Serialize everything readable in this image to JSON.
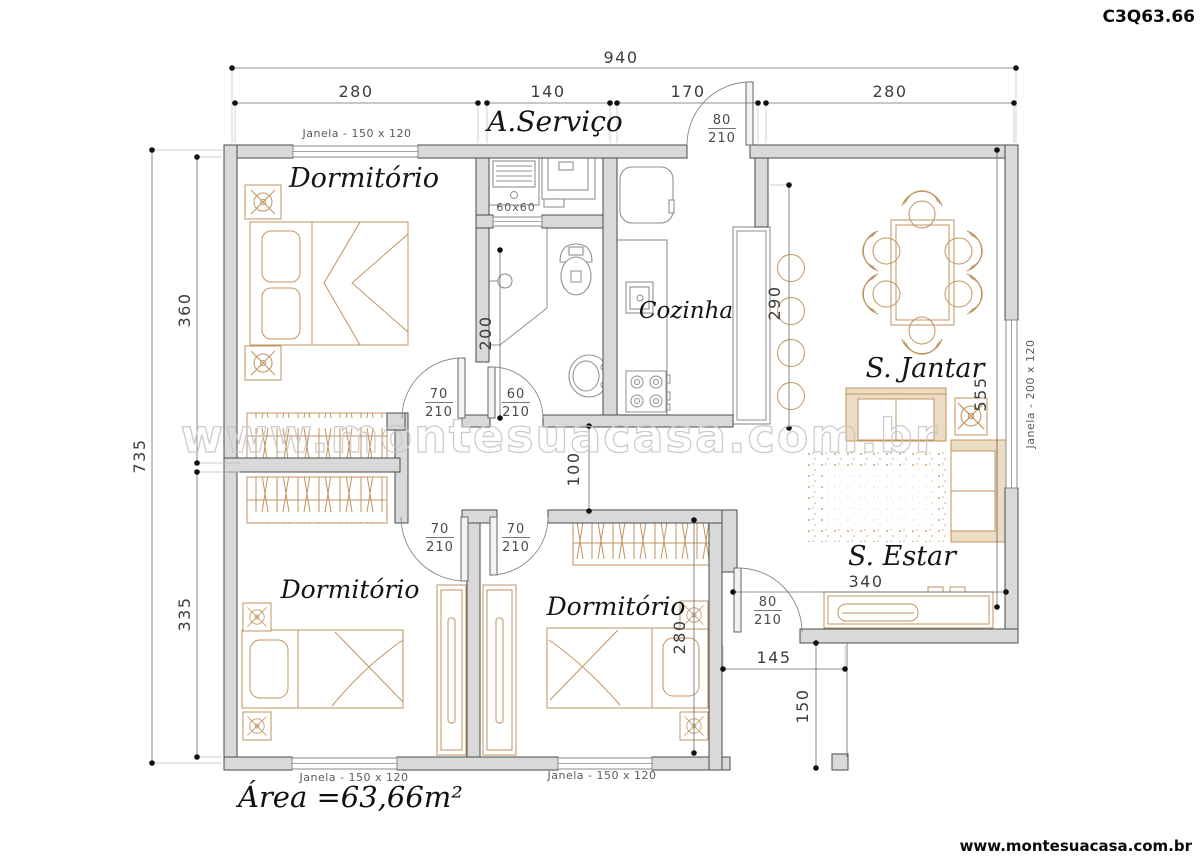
{
  "title_code": "C3Q63.66",
  "footer_url": "www.montesuacasa.com.br",
  "watermark": "www.montesuacasa.com.br",
  "area_label": "Área =63,66m²",
  "rooms": {
    "bedroom1": "Dormitório",
    "bedroom2": "Dormitório",
    "bedroom3": "Dormitório",
    "kitchen": "Cozinha",
    "laundry": "A.Serviço",
    "dining": "S. Jantar",
    "living": "S. Estar"
  },
  "window_labels": {
    "bedroom1": "Janela - 150 x 120",
    "bedroom2": "Janela - 150 x 120",
    "bedroom3": "Janela - 150 x 120",
    "living": "Janela - 200 x 120"
  },
  "dimensions": {
    "overall_width": "940",
    "overall_height": "735",
    "top_segments": {
      "bedroom1": "280",
      "laundry": "140",
      "kitchen": "170",
      "dining": "280"
    },
    "left_segments": {
      "bedroom1": "360",
      "bedroom2": "335"
    },
    "bathroom_depth": "200",
    "hall_width": "100",
    "counter_length": "290",
    "living_height": "555",
    "bedroom3_depth": "280",
    "tv_wall": "340",
    "porch_width": "145",
    "porch_depth": "150"
  },
  "doors": {
    "entry": {
      "width": "80",
      "height": "210"
    },
    "bedroom1": {
      "width": "70",
      "height": "210"
    },
    "bathroom": {
      "width": "60",
      "height": "210"
    },
    "bedroom2": {
      "width": "70",
      "height": "210"
    },
    "bedroom3": {
      "width": "70",
      "height": "210"
    },
    "porch": {
      "width": "80",
      "height": "210"
    }
  },
  "fixtures": {
    "tank_size": "60x60"
  }
}
